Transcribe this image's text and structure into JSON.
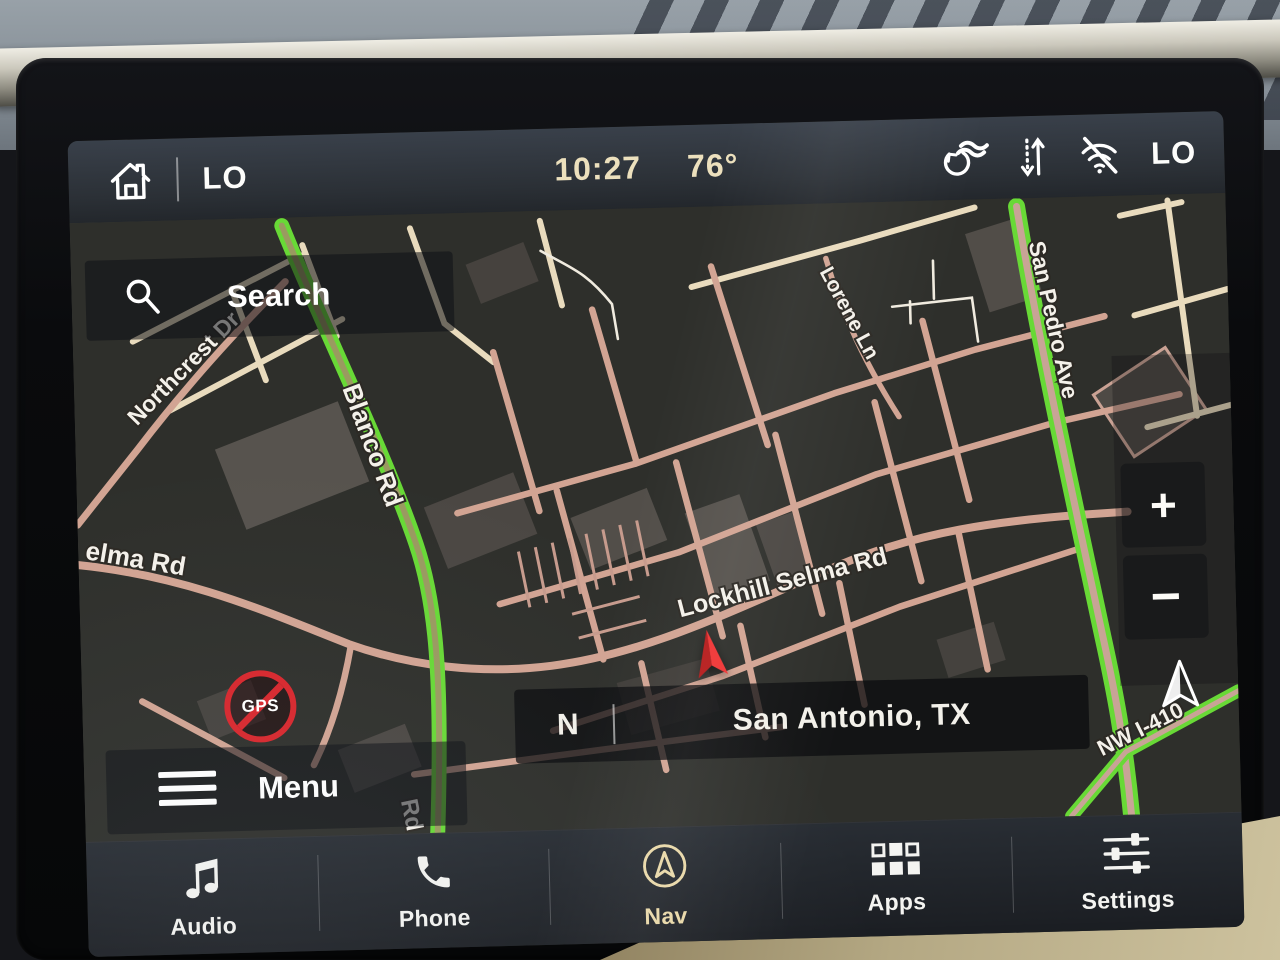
{
  "status_bar": {
    "driver_temp": "LO",
    "time": "10:27",
    "outside_temp": "76°",
    "passenger_temp": "LO"
  },
  "map": {
    "search_label": "Search",
    "menu_label": "Menu",
    "location_bar": {
      "compass_letter": "N",
      "location": "San Antonio, TX"
    },
    "zoom_in_label": "+",
    "zoom_out_label": "−",
    "gps_badge_label": "GPS",
    "streets": {
      "northcrest": "Northcrest Dr",
      "blanco": "Blanco Rd",
      "lorene": "Lorene Ln",
      "san_pedro": "San Pedro Ave",
      "selma_partial": "elma Rd",
      "lockhill_selma": "Lockhill Selma Rd",
      "nw_i410": "NW I-410",
      "blanco_partial": "Rd"
    }
  },
  "dock": {
    "items": [
      {
        "label": "Audio",
        "active": false
      },
      {
        "label": "Phone",
        "active": false
      },
      {
        "label": "Nav",
        "active": true
      },
      {
        "label": "Apps",
        "active": false
      },
      {
        "label": "Settings",
        "active": false
      }
    ]
  },
  "colors": {
    "accent_cream": "#ead9a8",
    "status_text_cream": "#ece0bd",
    "traffic_green": "#68d936",
    "road_pink": "#d2a493",
    "road_cream": "#e9dbbd",
    "alert_red": "#d8262c",
    "vehicle_red": "#ef3434"
  }
}
